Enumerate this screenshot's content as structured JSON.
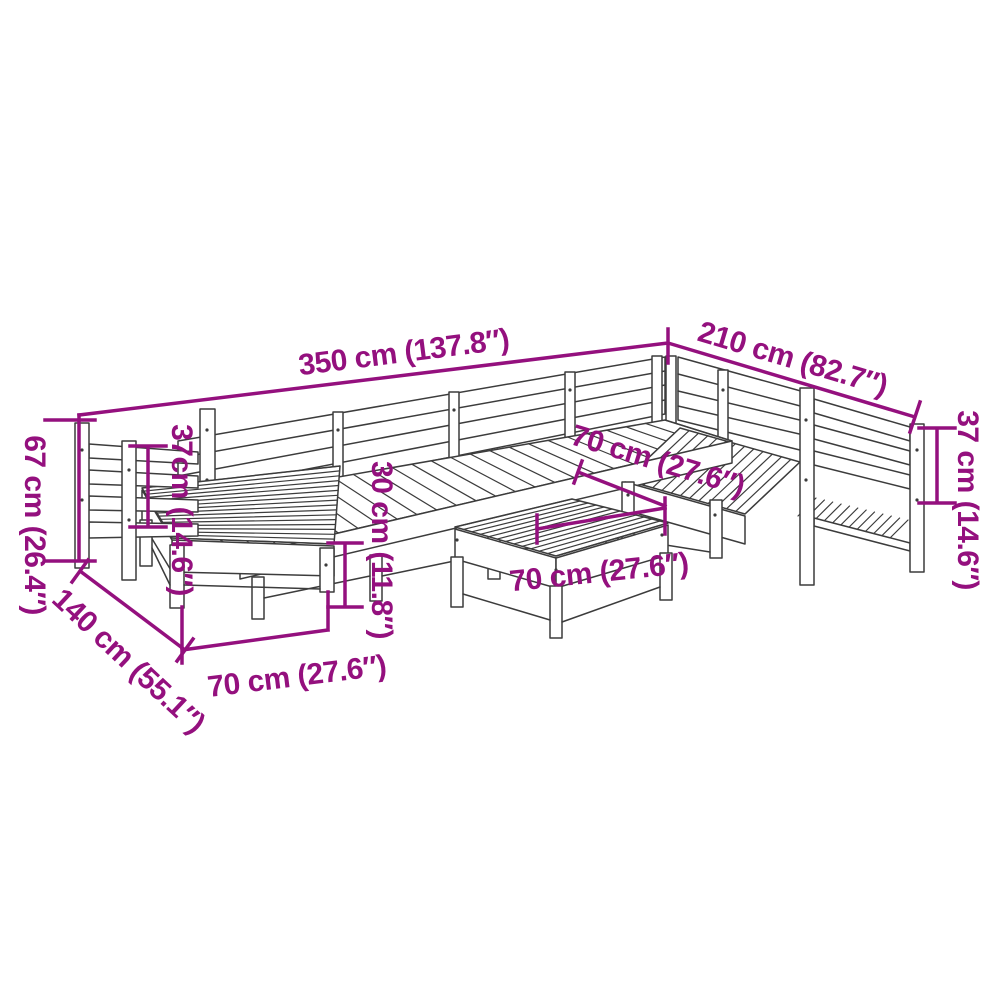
{
  "figure": {
    "kind": "product-dimension-diagram",
    "background_color": "#ffffff",
    "drawing_line_color": "#3c3c3c",
    "dimension_color": "#94107e"
  },
  "dimensions": {
    "overall_width": "350 cm (137.8″)",
    "overall_depth": "210 cm (82.7″)",
    "overall_height": "67 cm (26.4″)",
    "backrest_height_left": "37cm (14.6″)",
    "backrest_height_right": "37 cm (14.6″)",
    "seat_height": "30 cm (11.8″)",
    "seat_depth": "70 cm (27.6″)",
    "table_width": "70 cm (27.6″)",
    "module_width": "70 cm (27.6″)",
    "chaise_depth": "140 cm (55.1″)"
  }
}
